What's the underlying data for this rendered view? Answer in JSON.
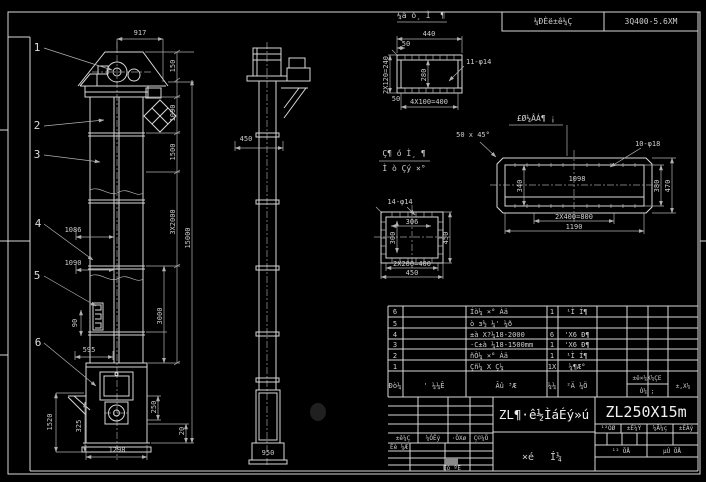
{
  "frame": {
    "bg": "#000000",
    "line": "#d8d8d8",
    "dim": "#b0b0b0"
  },
  "stamp": {
    "left_label": "¼ÐÈë±ê¼Ç",
    "right_label": "3Q400-5.6XM"
  },
  "front_view": {
    "balloons": {
      "b1": "1",
      "b2": "2",
      "b3": "3",
      "b4": "4",
      "b5": "5",
      "b6": "6"
    },
    "dims": {
      "w917": "917",
      "h150": "150",
      "h1090": "1090",
      "h1500": "1500",
      "h15000": "15000",
      "h3x2000": "3X2000",
      "h3000": "3000",
      "h250": "250",
      "h20": "20",
      "l1086": "1086",
      "l1090": "1090",
      "l595": "595",
      "l90": "90",
      "l1520": "1520",
      "l325": "325",
      "w1298": "1298"
    }
  },
  "side_view": {
    "dims": {
      "w450": "450",
      "w950": "950"
    }
  },
  "detail_top": {
    "title": "¼ä ó¸ Ì¨ ¶",
    "holes": "11-φ14",
    "dims": {
      "w440": "440",
      "w50": "50",
      "v240": "2X120=240",
      "v280": "280",
      "b50": "50",
      "b400": "4X100=400"
    }
  },
  "detail_square": {
    "holes": "14-φ14",
    "dims": {
      "w306": "306",
      "v300": "300",
      "v450": "450",
      "b400": "2X200=400",
      "b450": "450"
    }
  },
  "detail_long": {
    "note": "£Ø¼ÂÁ¶ ¡",
    "chamfer": "50 x 45°",
    "holes": "10-φ18",
    "dims": {
      "w1098": "1098",
      "v340": "340",
      "v380": "380",
      "v470": "470",
      "b800": "2X400=800",
      "b1190": "1190"
    }
  },
  "section_label": {
    "line1": "Ç¶ ó Ì¸ ¶",
    "line2": "Ì ò Çý ×°"
  },
  "bom": {
    "headers": {
      "no": "Ðò¼",
      "code": "' ¼¼Ê",
      "name": "Ãû ³Æ",
      "qty": "¼¼",
      "material": "²Ä ¼Ö",
      "std": "±ê×¼X¼ÇE",
      "use": "Ó¼ ;",
      "note": "±,X¼"
    },
    "rows": [
      {
        "no": "6",
        "code": "",
        "name": "Íò¼ ×° Àä",
        "qty": "1",
        "material": "¹Ì Í¶"
      },
      {
        "no": "5",
        "code": "",
        "name": "ò з½ ¼' ¼ð",
        "qty": "",
        "material": ""
      },
      {
        "no": "4",
        "code": "",
        "name": "±à X?¼18-2000",
        "qty": "6",
        "material": "'X6 Ð¶"
      },
      {
        "no": "3",
        "code": "",
        "name": "·C±à ¼18-1500mm",
        "qty": "1",
        "material": "'X6 Ð¶"
      },
      {
        "no": "2",
        "code": "",
        "name": "ñÒ¼ ×° Àä",
        "qty": "1",
        "material": "¹Ì Í¶"
      },
      {
        "no": "1",
        "code": "",
        "name": "Çñ¼ X Ç¼",
        "qty": "1X",
        "material": "¼¶Æ°"
      }
    ]
  },
  "title_block": {
    "drawing_title": "ZL¶·ê½ÌáÉý»ú",
    "model": "ZL250X15m",
    "sub1": "×é",
    "sub2": "Í¼",
    "left_labels": {
      "c1": "±ê¼Ç",
      "c2": "¼ÓÊý",
      "c3": "·ÖXø",
      "c4": "Ç©¼Ö"
    },
    "row_design": "Éè ¼Æ",
    "row_audit": "Éó ºË",
    "right_headers": {
      "c1": "¹²ÖØ",
      "c2": "±È¼Ý",
      "c3": "¼Ä¼ç",
      "c4": "±ÈÀý"
    },
    "pages_total": "¹² ÕÅ",
    "pages_no": "µÚ ÕÅ"
  }
}
